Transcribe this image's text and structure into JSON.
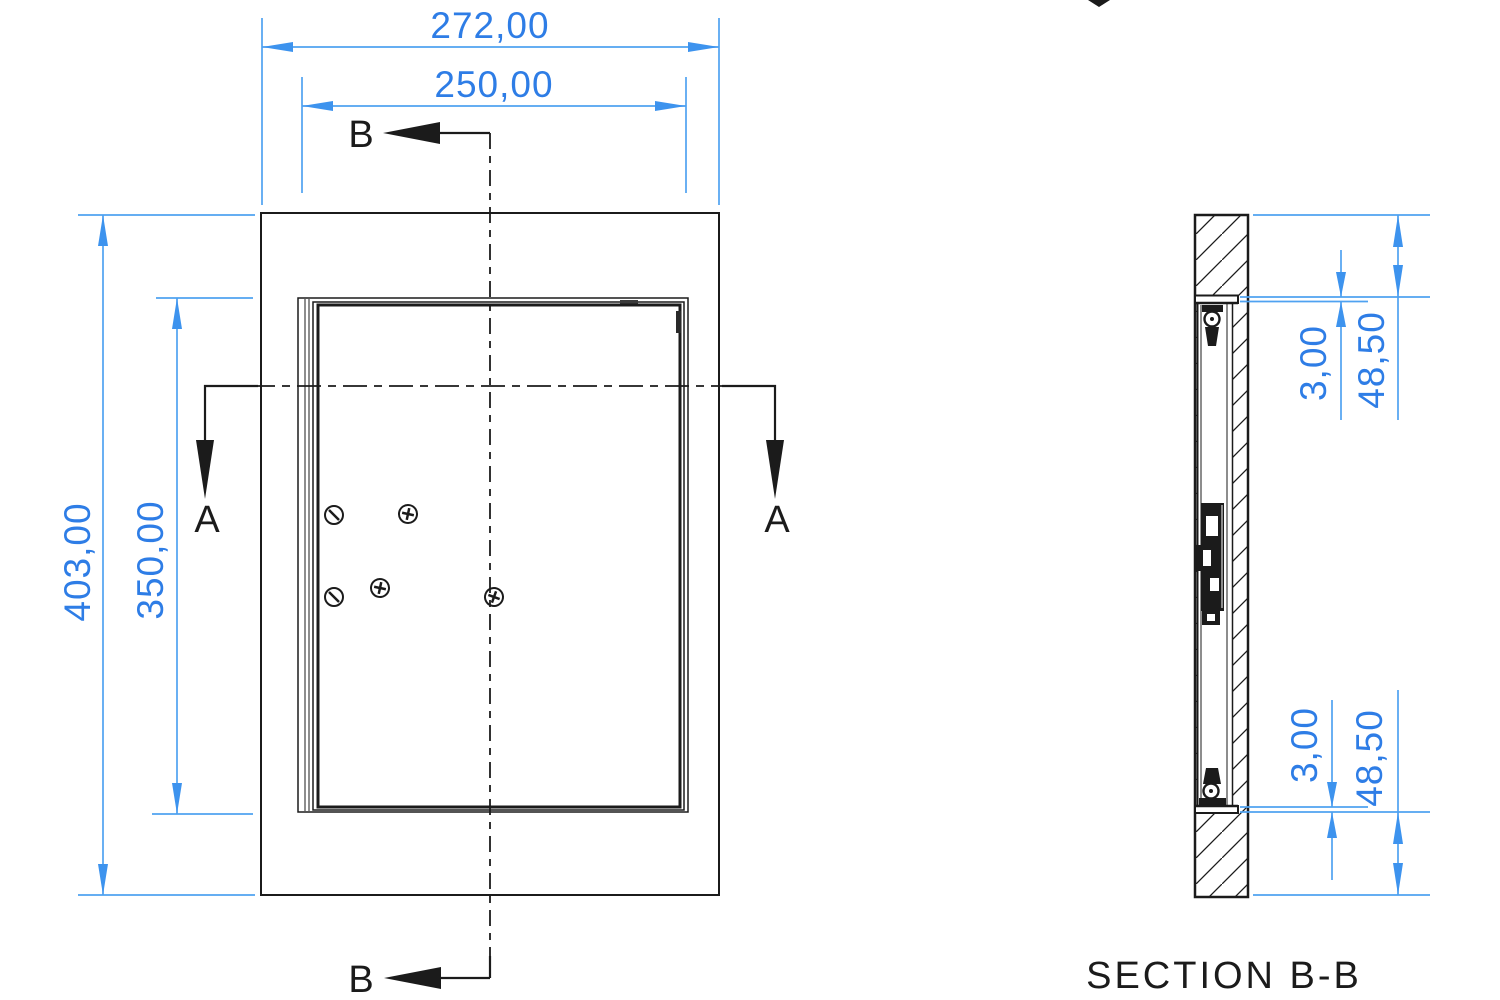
{
  "front_view": {
    "dims": {
      "outer_width": "272,00",
      "inner_width": "250,00",
      "outer_height": "403,00",
      "inner_height": "350,00"
    },
    "markers": {
      "section_b_top": "B",
      "section_b_bottom": "B",
      "section_a_left": "A",
      "section_a_right": "A"
    }
  },
  "section_view": {
    "title": "SECTION B-B",
    "dims": {
      "top_panel_thickness": "3,00",
      "top_frame_depth": "48,50",
      "bottom_panel_thickness": "3,00",
      "bottom_frame_depth": "48,50"
    }
  },
  "colors": {
    "dimension_line": "#4fa2f1",
    "dimension_text": "#2e7de6",
    "drawing_line": "#1b1b1b"
  }
}
